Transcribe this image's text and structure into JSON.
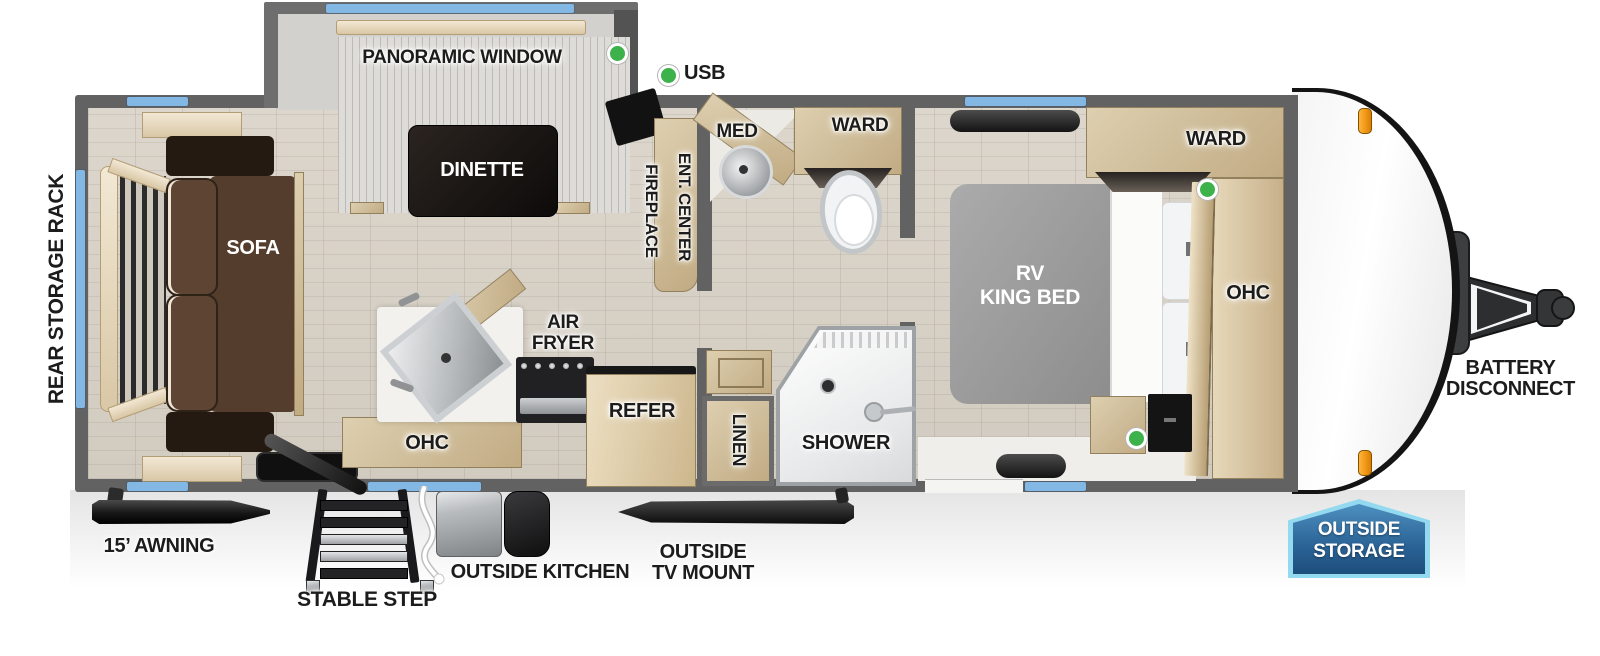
{
  "legend": {
    "usb": "USB"
  },
  "slide": {
    "panoramic_window": "PANORAMIC WINDOW",
    "dinette": "DINETTE"
  },
  "living": {
    "rear_storage_rack": "REAR STORAGE RACK",
    "sofa": "SOFA"
  },
  "kitchen": {
    "air_fryer_line1": "AIR",
    "air_fryer_line2": "FRYER",
    "ohc": "OHC",
    "refer": "REFER"
  },
  "entertainment": {
    "ent_center": "ENT. CENTER",
    "fireplace": "FIREPLACE"
  },
  "bathroom": {
    "med": "MED",
    "ward": "WARD",
    "linen": "LINEN",
    "shower": "SHOWER"
  },
  "bedroom": {
    "bed_line1": "RV",
    "bed_line2": "KING BED",
    "ward": "WARD",
    "ohc": "OHC"
  },
  "front": {
    "battery_line1": "BATTERY",
    "battery_line2": "DISCONNECT"
  },
  "badges": {
    "outside_storage_line1": "OUTSIDE",
    "outside_storage_line2": "STORAGE"
  },
  "exterior": {
    "awning": "15’ AWNING",
    "stable_step": "STABLE STEP",
    "outside_kitchen": "OUTSIDE KITCHEN",
    "outside_tv_line1": "OUTSIDE",
    "outside_tv_line2": "TV MOUNT"
  },
  "colors": {
    "window_blue": "#84b8e4",
    "indicator_green": "#3db14a",
    "badge_blue": "#2b6396",
    "badge_border": "#93d9f0",
    "clearance_orange": "#f59a1e",
    "wall_gray": "#626262"
  }
}
